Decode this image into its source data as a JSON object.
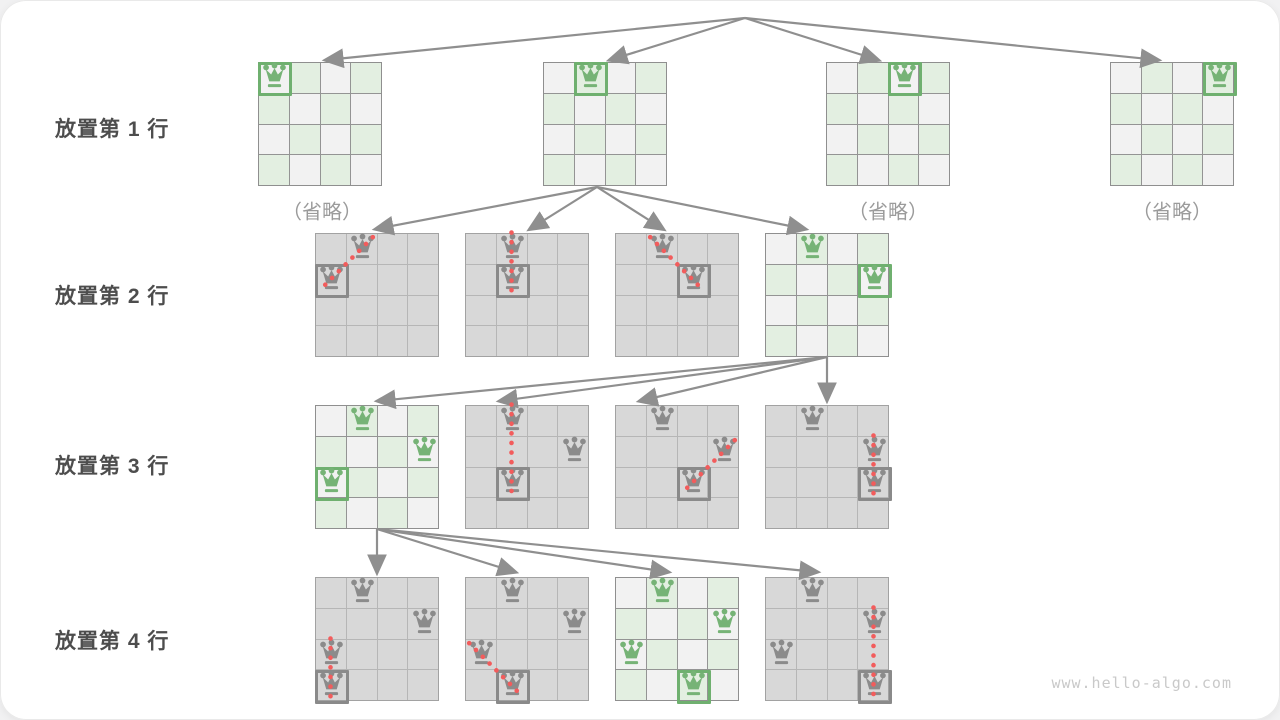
{
  "page": {
    "watermark": "www.hello-algo.com"
  },
  "colors": {
    "board_green_cell": "#e3efe1",
    "board_light_cell": "#f2f2f2",
    "board_gray_cell": "#d8d8d8",
    "queen_green": "#76b376",
    "queen_gray": "#8b8b8b",
    "box_green": "#6fb06f",
    "box_gray": "#8a8a8a",
    "conflict_red": "#f25c5c",
    "arrow": "#8f8f8f",
    "label_text": "#4d4d4d"
  },
  "row_labels": [
    {
      "text": "放置第 1 行",
      "y": 128
    },
    {
      "text": "放置第 2 行",
      "y": 295
    },
    {
      "text": "放置第 3 行",
      "y": 465
    },
    {
      "text": "放置第 4 行",
      "y": 640
    }
  ],
  "omitted_labels": [
    {
      "text": "（省略）",
      "x": 322,
      "y": 210
    },
    {
      "text": "（省略）",
      "x": 888,
      "y": 210
    },
    {
      "text": "（省略）",
      "x": 1172,
      "y": 210
    }
  ],
  "boards": [
    {
      "name": "row1-board1",
      "x": 258,
      "y": 62,
      "style": "active",
      "queens": [
        {
          "r": 0,
          "c": 0,
          "boxed": true
        }
      ]
    },
    {
      "name": "row1-board2",
      "x": 543,
      "y": 62,
      "style": "active",
      "queens": [
        {
          "r": 0,
          "c": 1,
          "boxed": true
        }
      ]
    },
    {
      "name": "row1-board3",
      "x": 826,
      "y": 62,
      "style": "active",
      "queens": [
        {
          "r": 0,
          "c": 2,
          "boxed": true
        }
      ]
    },
    {
      "name": "row1-board4",
      "x": 1110,
      "y": 62,
      "style": "active",
      "queens": [
        {
          "r": 0,
          "c": 3,
          "boxed": true
        }
      ]
    },
    {
      "name": "row2-board1",
      "x": 315,
      "y": 233,
      "style": "pruned",
      "queens": [
        {
          "r": 0,
          "c": 1
        },
        {
          "r": 1,
          "c": 0,
          "boxed": true
        }
      ],
      "conflict": {
        "from": [
          0,
          1
        ],
        "to": [
          1,
          0
        ]
      }
    },
    {
      "name": "row2-board2",
      "x": 465,
      "y": 233,
      "style": "pruned",
      "queens": [
        {
          "r": 0,
          "c": 1
        },
        {
          "r": 1,
          "c": 1,
          "boxed": true
        }
      ],
      "conflict": {
        "from": [
          0,
          1
        ],
        "to": [
          1,
          1
        ]
      }
    },
    {
      "name": "row2-board3",
      "x": 615,
      "y": 233,
      "style": "pruned",
      "queens": [
        {
          "r": 0,
          "c": 1
        },
        {
          "r": 1,
          "c": 2,
          "boxed": true
        }
      ],
      "conflict": {
        "from": [
          0,
          1
        ],
        "to": [
          1,
          2
        ]
      }
    },
    {
      "name": "row2-board4",
      "x": 765,
      "y": 233,
      "style": "active",
      "queens": [
        {
          "r": 0,
          "c": 1
        },
        {
          "r": 1,
          "c": 3,
          "boxed": true
        }
      ]
    },
    {
      "name": "row3-board1",
      "x": 315,
      "y": 405,
      "style": "active",
      "queens": [
        {
          "r": 0,
          "c": 1
        },
        {
          "r": 1,
          "c": 3
        },
        {
          "r": 2,
          "c": 0,
          "boxed": true
        }
      ]
    },
    {
      "name": "row3-board2",
      "x": 465,
      "y": 405,
      "style": "pruned",
      "queens": [
        {
          "r": 0,
          "c": 1
        },
        {
          "r": 1,
          "c": 3
        },
        {
          "r": 2,
          "c": 1,
          "boxed": true
        }
      ],
      "conflict": {
        "from": [
          0,
          1
        ],
        "to": [
          2,
          1
        ]
      }
    },
    {
      "name": "row3-board3",
      "x": 615,
      "y": 405,
      "style": "pruned",
      "queens": [
        {
          "r": 0,
          "c": 1
        },
        {
          "r": 1,
          "c": 3
        },
        {
          "r": 2,
          "c": 2,
          "boxed": true
        }
      ],
      "conflict": {
        "from": [
          1,
          3
        ],
        "to": [
          2,
          2
        ]
      }
    },
    {
      "name": "row3-board4",
      "x": 765,
      "y": 405,
      "style": "pruned",
      "queens": [
        {
          "r": 0,
          "c": 1
        },
        {
          "r": 1,
          "c": 3
        },
        {
          "r": 2,
          "c": 3,
          "boxed": true
        }
      ],
      "conflict": {
        "from": [
          1,
          3
        ],
        "to": [
          2,
          3
        ]
      }
    },
    {
      "name": "row4-board1",
      "x": 315,
      "y": 577,
      "style": "pruned",
      "queens": [
        {
          "r": 0,
          "c": 1
        },
        {
          "r": 1,
          "c": 3
        },
        {
          "r": 2,
          "c": 0
        },
        {
          "r": 3,
          "c": 0,
          "boxed": true
        }
      ],
      "conflict": {
        "from": [
          2,
          0
        ],
        "to": [
          3,
          0
        ]
      }
    },
    {
      "name": "row4-board2",
      "x": 465,
      "y": 577,
      "style": "pruned",
      "queens": [
        {
          "r": 0,
          "c": 1
        },
        {
          "r": 1,
          "c": 3
        },
        {
          "r": 2,
          "c": 0
        },
        {
          "r": 3,
          "c": 1,
          "boxed": true
        }
      ],
      "conflict": {
        "from": [
          2,
          0
        ],
        "to": [
          3,
          1
        ]
      }
    },
    {
      "name": "row4-board3",
      "x": 615,
      "y": 577,
      "style": "active",
      "queens": [
        {
          "r": 0,
          "c": 1
        },
        {
          "r": 1,
          "c": 3
        },
        {
          "r": 2,
          "c": 0
        },
        {
          "r": 3,
          "c": 2,
          "boxed": true
        }
      ]
    },
    {
      "name": "row4-board4",
      "x": 765,
      "y": 577,
      "style": "pruned",
      "queens": [
        {
          "r": 0,
          "c": 1
        },
        {
          "r": 1,
          "c": 3
        },
        {
          "r": 2,
          "c": 0
        },
        {
          "r": 3,
          "c": 3,
          "boxed": true
        }
      ],
      "conflict": {
        "from": [
          1,
          3
        ],
        "to": [
          3,
          3
        ]
      }
    }
  ],
  "arrows": [
    {
      "x1": 745,
      "y1": 18,
      "x2": 326,
      "y2": 60
    },
    {
      "x1": 745,
      "y1": 18,
      "x2": 610,
      "y2": 60
    },
    {
      "x1": 745,
      "y1": 18,
      "x2": 878,
      "y2": 60
    },
    {
      "x1": 745,
      "y1": 18,
      "x2": 1158,
      "y2": 60
    },
    {
      "x1": 597,
      "y1": 187,
      "x2": 376,
      "y2": 229
    },
    {
      "x1": 597,
      "y1": 187,
      "x2": 530,
      "y2": 229
    },
    {
      "x1": 597,
      "y1": 187,
      "x2": 663,
      "y2": 229
    },
    {
      "x1": 597,
      "y1": 187,
      "x2": 805,
      "y2": 229
    },
    {
      "x1": 827,
      "y1": 357,
      "x2": 378,
      "y2": 401
    },
    {
      "x1": 827,
      "y1": 357,
      "x2": 500,
      "y2": 401
    },
    {
      "x1": 827,
      "y1": 357,
      "x2": 640,
      "y2": 401
    },
    {
      "x1": 827,
      "y1": 357,
      "x2": 827,
      "y2": 400
    },
    {
      "x1": 377,
      "y1": 529,
      "x2": 377,
      "y2": 572
    },
    {
      "x1": 377,
      "y1": 529,
      "x2": 515,
      "y2": 572
    },
    {
      "x1": 377,
      "y1": 529,
      "x2": 668,
      "y2": 572
    },
    {
      "x1": 377,
      "y1": 529,
      "x2": 817,
      "y2": 572
    }
  ]
}
